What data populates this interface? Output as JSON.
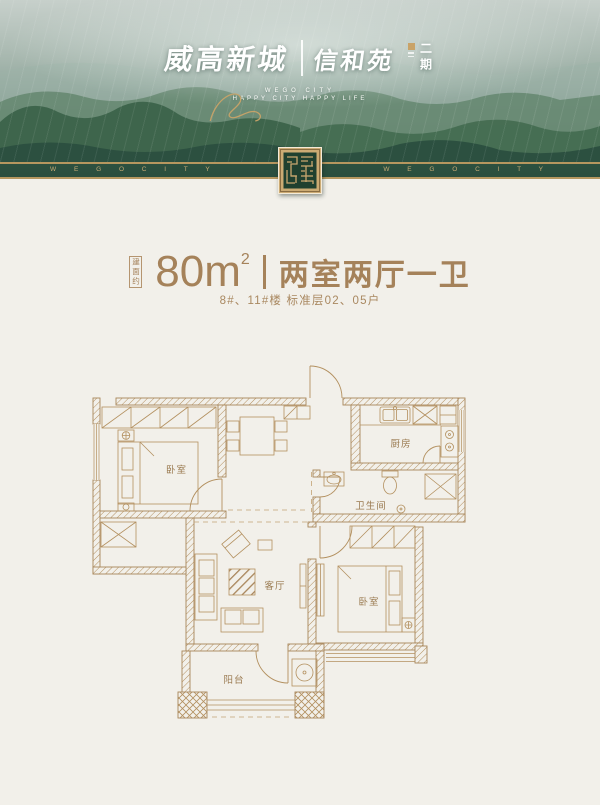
{
  "hero": {
    "brand": "威高新城",
    "sub_brand": "信和苑",
    "phase": "二期",
    "tagline_line1": "WEGO CITY",
    "tagline_line2": "HAPPY CITY HAPPY LIFE"
  },
  "band": {
    "repeat_text_left": "W E G O C I T Y",
    "repeat_text_right": "W E G O C I T Y"
  },
  "unit": {
    "area_prefix": "建面约",
    "area_value": "80",
    "area_unit": "m",
    "area_sup": "2",
    "layout": "两室两厅一卫",
    "subtitle": "8#、11#楼 标准层02、05户"
  },
  "floorplan": {
    "rooms": [
      {
        "id": "bedroom-1",
        "label": "卧室"
      },
      {
        "id": "kitchen",
        "label": "厨房"
      },
      {
        "id": "bathroom",
        "label": "卫生间"
      },
      {
        "id": "living-room",
        "label": "客厅"
      },
      {
        "id": "bedroom-2",
        "label": "卧室"
      },
      {
        "id": "balcony",
        "label": "阳台"
      }
    ]
  },
  "colors": {
    "accent_gold": "#a5825a",
    "band_green": "#2b4e3e",
    "seal_green": "#20402f",
    "plan_line": "#b3905f",
    "background": "#f2f0ea"
  }
}
